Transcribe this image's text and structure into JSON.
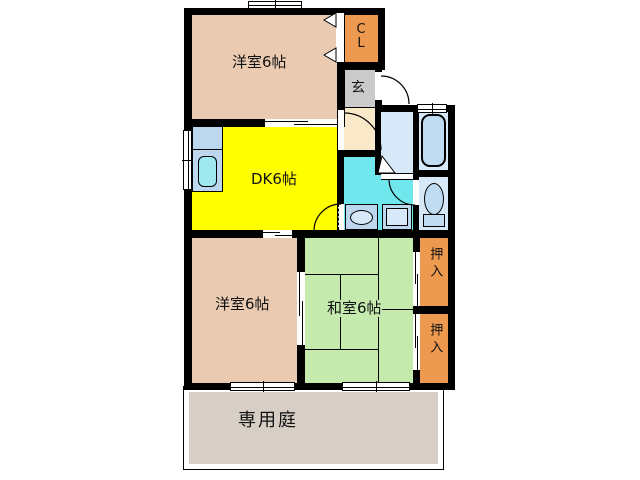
{
  "floorplan": {
    "wall_color": "#000000",
    "rooms": {
      "bedroom_top": {
        "label": "洋室6帖",
        "color": "#EACBB2"
      },
      "dk": {
        "label": "DK6帖",
        "color": "#FFFF00"
      },
      "bedroom_bottom": {
        "label": "洋室6帖",
        "color": "#EACBB2"
      },
      "washitsu": {
        "label": "和室6帖",
        "color": "#C4EAAE"
      },
      "cl": {
        "label": "CL",
        "lines": [
          "C",
          "L"
        ],
        "color": "#ED9950"
      },
      "genkan": {
        "label": "玄",
        "color": "#CBCBCB"
      },
      "hallway": {
        "color": "#FAE9C8"
      },
      "washroom": {
        "color": "#6FE7ED"
      },
      "bathroom": {
        "color": "#D7E9F8"
      },
      "toilet": {
        "color": "#D7E9F8"
      },
      "oshiire_top": {
        "label": "押入",
        "color": "#ED9950"
      },
      "oshiire_bottom": {
        "label": "押入",
        "color": "#ED9950"
      },
      "garden": {
        "label": "専用庭",
        "color": "#D7CFC5"
      }
    }
  }
}
